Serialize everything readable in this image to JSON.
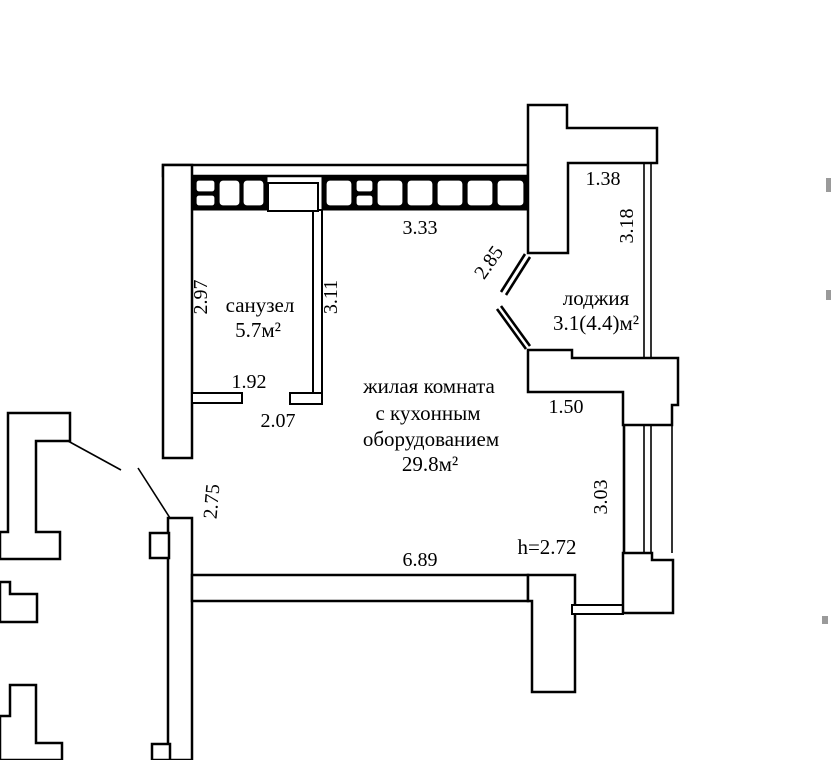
{
  "document": {
    "type": "floor-plan",
    "background_color": "#ffffff",
    "line_color": "#000000"
  },
  "rooms": {
    "bathroom": {
      "label": "санузел",
      "area": "5.7м²"
    },
    "living": {
      "label_line1": "жилая комната",
      "label_line2": "с кухонным",
      "label_line3": "оборудованием",
      "area": "29.8м²",
      "ceiling_height": "h=2.72"
    },
    "loggia": {
      "label": "лоджия",
      "area": "3.1(4.4)м²"
    }
  },
  "dimensions": {
    "bathroom_height": "2.97",
    "room_left_wall": "3.11",
    "bathroom_stub": "1.92",
    "bathroom_opening": "2.07",
    "top_window": "3.33",
    "loggia_angled_glazing": "2.85",
    "loggia_top": "1.38",
    "loggia_side": "3.18",
    "room_right_top": "1.50",
    "entrance_wall": "2.75",
    "room_bottom": "6.89",
    "right_window": "3.03"
  }
}
